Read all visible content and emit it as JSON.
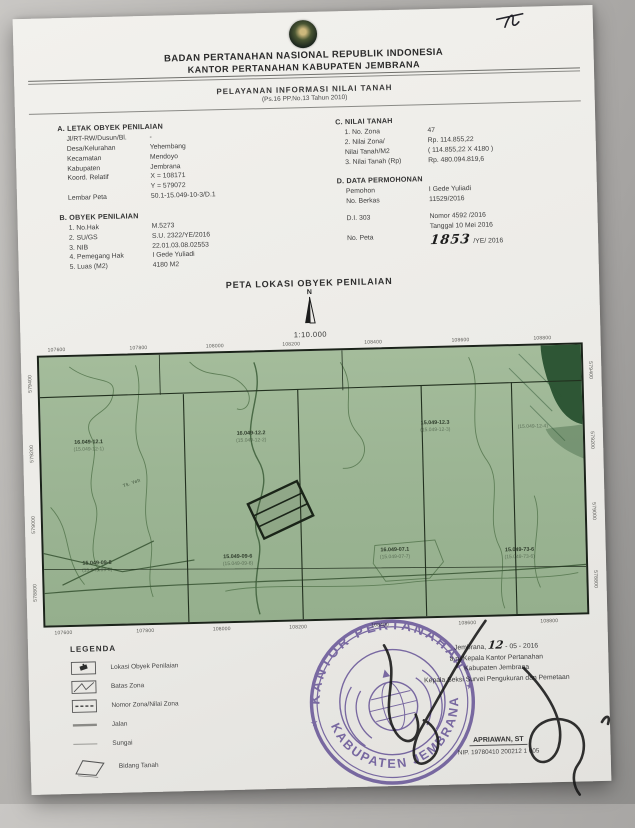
{
  "document": {
    "header": {
      "agency_line1": "BADAN PERTANAHAN NASIONAL REPUBLIK INDONESIA",
      "agency_line2": "KANTOR PERTANAHAN KABUPATEN JEMBRANA",
      "service_title": "PELAYANAN INFORMASI NILAI TANAH",
      "service_subtitle": "(Ps.16 PP.No.13 Tahun 2010)"
    },
    "section_a": {
      "title": "A. LETAK OBYEK PENILAIAN",
      "rows": [
        {
          "label": "Jl/RT-RW/Dusun/Bl.",
          "value": "-"
        },
        {
          "label": "Desa/Kelurahan",
          "value": "Yehembang"
        },
        {
          "label": "Kecamatan",
          "value": "Mendoyo"
        },
        {
          "label": "Kabupaten",
          "value": "Jembrana"
        },
        {
          "label": "Koord. Relatif",
          "value": "X = 108171"
        },
        {
          "label": "",
          "value": "Y = 579072"
        },
        {
          "label": "Lembar Peta",
          "value": "50.1-15.049-10-3/D.1"
        }
      ]
    },
    "section_b": {
      "title": "B. OBYEK PENILAIAN",
      "rows": [
        {
          "label": "1. No.Hak",
          "value": "M.5273"
        },
        {
          "label": "2. SU/GS",
          "value": "S.U. 2322/YE/2016"
        },
        {
          "label": "3. NIB",
          "value": "22.01.03.08.02553"
        },
        {
          "label": "4. Pemegang Hak",
          "value": "I Gede Yuliadi"
        },
        {
          "label": "5. Luas (M2)",
          "value": "4180 M2"
        }
      ]
    },
    "section_c": {
      "title": "C. NILAI TANAH",
      "rows": [
        {
          "label": "1. No. Zona",
          "value": "47"
        },
        {
          "label": "2. Nilai Zona/",
          "value": "Rp. 114.855,22"
        },
        {
          "label": "Nilai Tanah/M2",
          "value": "( 114.855,22 X 4180 )"
        },
        {
          "label": "3. Nilai Tanah (Rp)",
          "value": "Rp. 480.094.819,6"
        }
      ]
    },
    "section_d": {
      "title": "D. DATA PERMOHONAN",
      "rows": [
        {
          "label": "Pemohon",
          "value": "I Gede Yuliadi"
        },
        {
          "label": "No. Berkas",
          "value": "11529/2016"
        },
        {
          "label": "D.I. 303",
          "value": "Nomor  4592 /2016"
        },
        {
          "label": "",
          "value": "Tanggal 10 Mei 2016"
        }
      ],
      "no_peta_label": "No. Peta",
      "no_peta_handwritten": "1853",
      "no_peta_suffix": "/YE/ 2016"
    }
  },
  "map": {
    "title": "PETA LOKASI OBYEK PENILAIAN",
    "north_label": "N",
    "scale_text": "1:10.000",
    "x_ticks": [
      "107600",
      "107800",
      "108000",
      "108200",
      "108400",
      "108600",
      "108800"
    ],
    "y_ticks": [
      "579400",
      "579200",
      "579000",
      "578800"
    ],
    "river_label": "Tk. Yeh",
    "zones": [
      {
        "main": "16.049-12.1",
        "sub": "(15.049-12-1)"
      },
      {
        "main": "16.049-12.2",
        "sub": "(15.049-12-2)"
      },
      {
        "main": "15.049-12.3",
        "sub": "(15.049-12-3)"
      },
      {
        "main": "",
        "sub": "(15.049-12-4)"
      },
      {
        "main": "15.049-09-8",
        "sub": "(15.049-09-8)"
      },
      {
        "main": "15.049-09-6",
        "sub": "(15.049-09-6)"
      },
      {
        "main": "16.049-07.1",
        "sub": "(15.049-07-7)"
      },
      {
        "main": "15.049-73-6",
        "sub": "(15.049-73-6)"
      }
    ],
    "colors": {
      "land": "#9cb594",
      "forest": "#2e5635",
      "contour": "#5f7f58",
      "border": "#1b231a"
    }
  },
  "legend": {
    "title": "LEGENDA",
    "items": [
      {
        "symbol": "object-location-symbol",
        "label": "Lokasi Obyek Penilaian"
      },
      {
        "symbol": "zone-boundary-symbol",
        "label": "Batas Zona"
      },
      {
        "symbol": "zone-number-symbol",
        "label": "Nomor Zona/Nilai Zona"
      },
      {
        "symbol": "road-symbol",
        "label": "Jalan"
      },
      {
        "symbol": "river-symbol",
        "label": "Sungai"
      },
      {
        "symbol": "land-parcel-symbol",
        "label": "Bidang Tanah"
      }
    ]
  },
  "signature_block": {
    "place": "Jembrana,",
    "date_handwritten": "12",
    "date_rest": "- 05 - 2016",
    "on_behalf": "a.n. Kepala Kantor Pertanahan",
    "office": "Kabupaten Jembrana",
    "position": "Kepala Seksi Survei Pengukuran dan Pemetaan",
    "name": "APRIAWAN, ST",
    "nip": "NIP. 19780410 200212 1 005"
  },
  "stamp": {
    "arc_top": "KANTOR PERTANAHAN",
    "arc_bottom": "KABUPATEN JEMBRANA",
    "separator": "★",
    "color": "#6a55a6"
  }
}
